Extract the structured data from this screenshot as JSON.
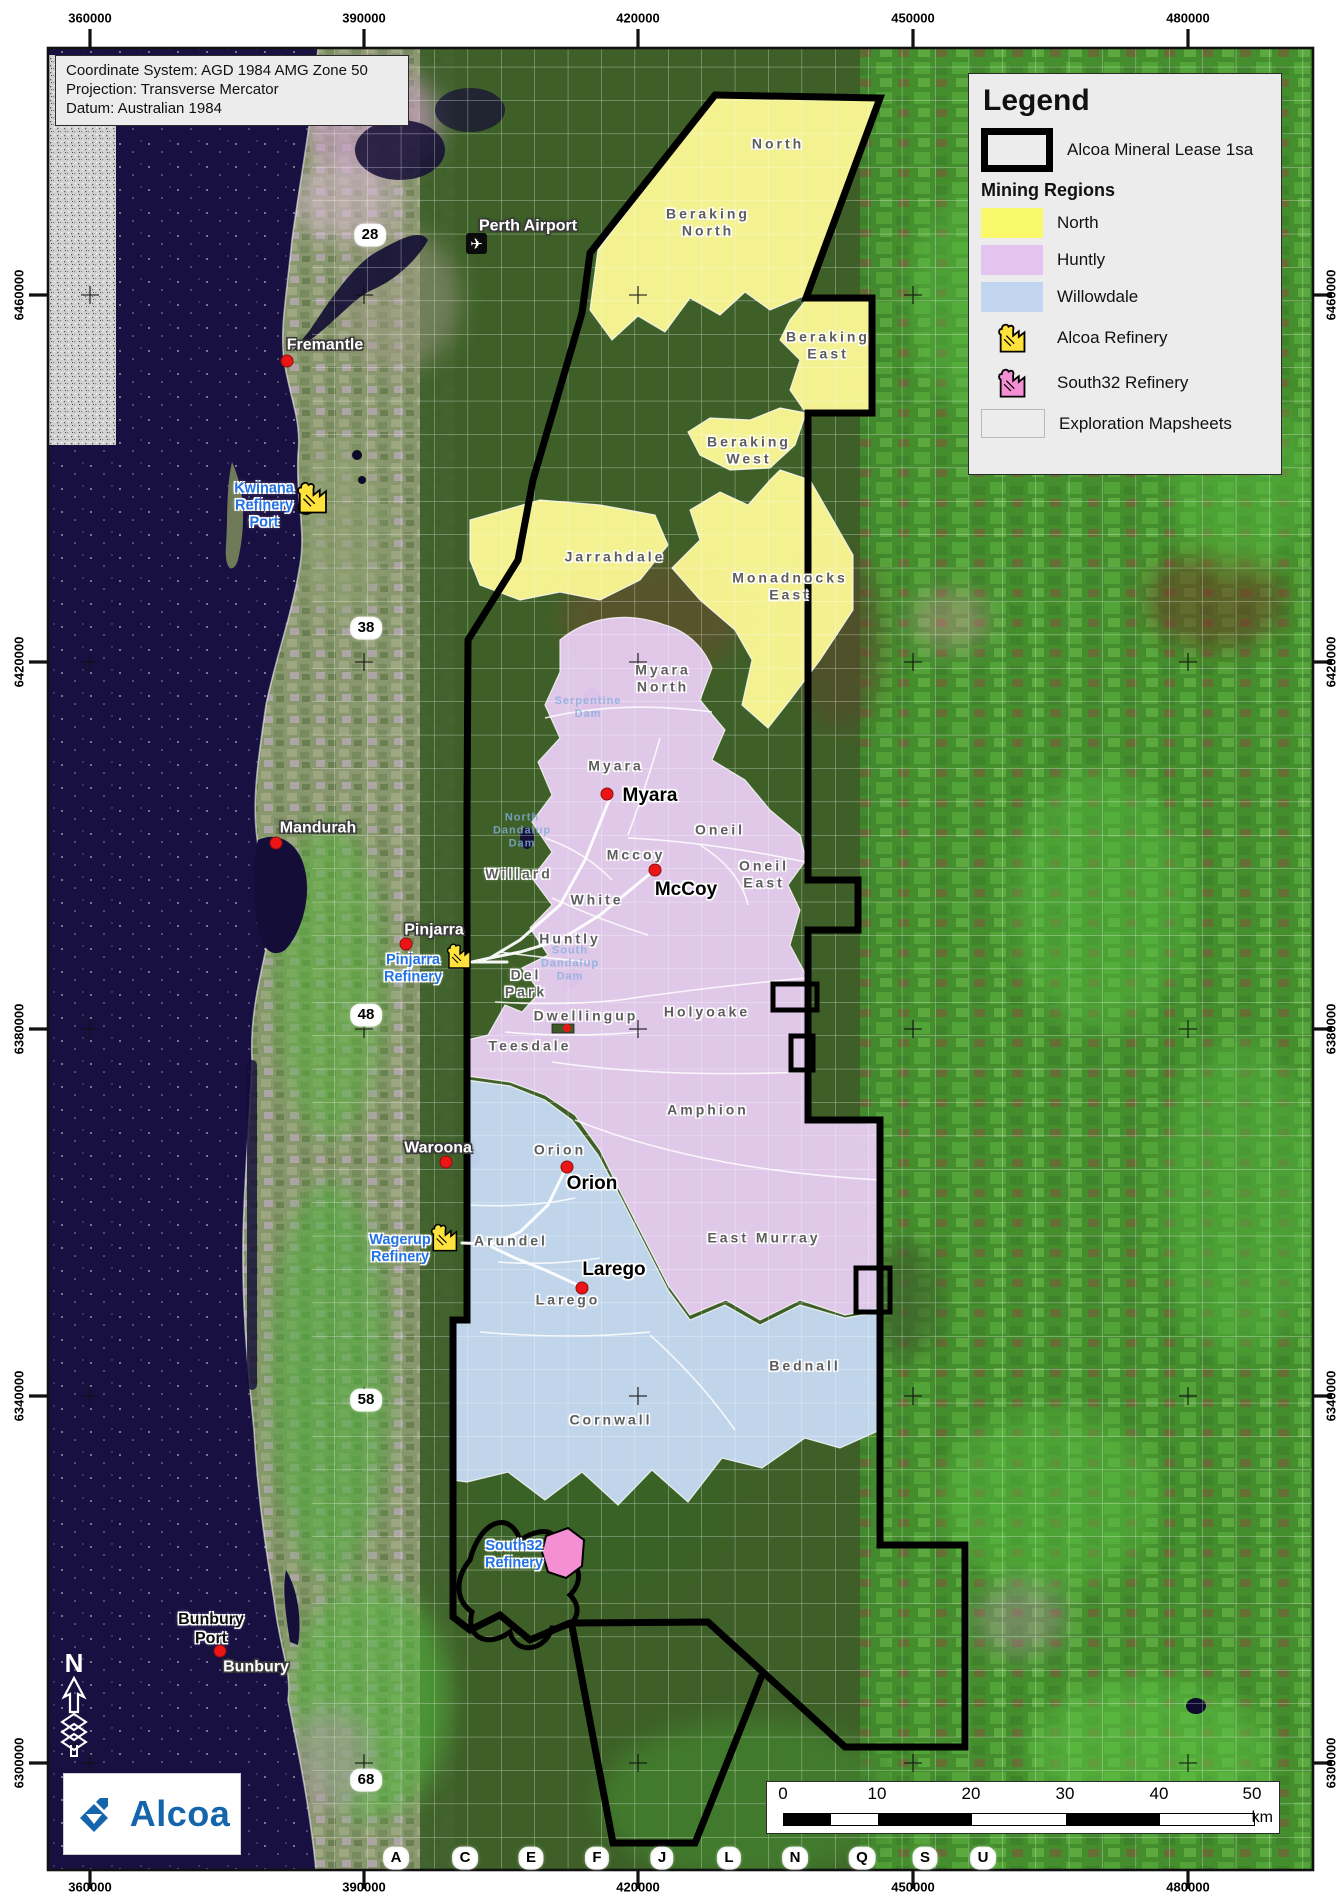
{
  "info_box": {
    "lines": [
      "Coordinate System: AGD 1984 AMG Zone 50",
      "Projection: Transverse Mercator",
      "Datum: Australian 1984"
    ]
  },
  "legend": {
    "title": "Legend",
    "lease_label": "Alcoa Mineral Lease 1sa",
    "mining_heading": "Mining Regions",
    "items": [
      {
        "label": "North",
        "color": "#FAF96B",
        "type": "region-swatch"
      },
      {
        "label": "Huntly",
        "color": "#E4C3F0",
        "type": "region-swatch"
      },
      {
        "label": "Willowdale",
        "color": "#C2D6F2",
        "type": "region-swatch"
      },
      {
        "label": "Alcoa Refinery",
        "color": "#FFE23B",
        "type": "refinery-icon"
      },
      {
        "label": "South32 Refinery",
        "color": "#F48FD4",
        "type": "refinery-icon"
      },
      {
        "label": "Exploration Mapsheets",
        "color": "#ECECEC",
        "type": "mapsheet-grid"
      }
    ]
  },
  "axes": {
    "top": [
      {
        "t": "360000",
        "x": 90
      },
      {
        "t": "390000",
        "x": 364
      },
      {
        "t": "420000",
        "x": 638
      },
      {
        "t": "450000",
        "x": 913
      },
      {
        "t": "480000",
        "x": 1188
      }
    ],
    "bottom": [
      {
        "t": "360000",
        "x": 90
      },
      {
        "t": "390000",
        "x": 364
      },
      {
        "t": "420000",
        "x": 638
      },
      {
        "t": "450000",
        "x": 913
      },
      {
        "t": "480000",
        "x": 1188
      }
    ],
    "left": [
      {
        "t": "6460000",
        "y": 295
      },
      {
        "t": "6420000",
        "y": 662
      },
      {
        "t": "6380000",
        "y": 1029
      },
      {
        "t": "6340000",
        "y": 1396
      },
      {
        "t": "6300000",
        "y": 1763
      }
    ],
    "right": [
      {
        "t": "6460000",
        "y": 295
      },
      {
        "t": "6420000",
        "y": 662
      },
      {
        "t": "6380000",
        "y": 1029
      },
      {
        "t": "6340000",
        "y": 1396
      },
      {
        "t": "6300000",
        "y": 1763
      }
    ]
  },
  "mapsheet_rows": [
    {
      "t": "28",
      "x": 370,
      "y": 235
    },
    {
      "t": "38",
      "x": 366,
      "y": 628
    },
    {
      "t": "48",
      "x": 366,
      "y": 1015
    },
    {
      "t": "58",
      "x": 366,
      "y": 1400
    },
    {
      "t": "68",
      "x": 366,
      "y": 1780
    }
  ],
  "mapsheet_cols": [
    {
      "t": "A",
      "x": 396,
      "y": 1858
    },
    {
      "t": "C",
      "x": 465,
      "y": 1858
    },
    {
      "t": "E",
      "x": 531,
      "y": 1858
    },
    {
      "t": "F",
      "x": 597,
      "y": 1858
    },
    {
      "t": "J",
      "x": 662,
      "y": 1858
    },
    {
      "t": "L",
      "x": 729,
      "y": 1858
    },
    {
      "t": "N",
      "x": 795,
      "y": 1858
    },
    {
      "t": "Q",
      "x": 862,
      "y": 1858
    },
    {
      "t": "S",
      "x": 925,
      "y": 1858
    },
    {
      "t": "U",
      "x": 983,
      "y": 1858
    }
  ],
  "regions": [
    {
      "t": "North",
      "x": 778,
      "y": 144
    },
    {
      "t": "Beraking\nNorth",
      "x": 708,
      "y": 222
    },
    {
      "t": "Beraking\nEast",
      "x": 828,
      "y": 345
    },
    {
      "t": "Beraking\nWest",
      "x": 749,
      "y": 450
    },
    {
      "t": "Jarrahdale",
      "x": 615,
      "y": 557
    },
    {
      "t": "Monadnocks\nEast",
      "x": 790,
      "y": 586
    },
    {
      "t": "Myara\nNorth",
      "x": 663,
      "y": 678
    },
    {
      "t": "Myara",
      "x": 616,
      "y": 766
    },
    {
      "t": "Oneil",
      "x": 720,
      "y": 830
    },
    {
      "t": "Mccoy",
      "x": 636,
      "y": 855
    },
    {
      "t": "Oneil\nEast",
      "x": 764,
      "y": 874
    },
    {
      "t": "Willard",
      "x": 519,
      "y": 874
    },
    {
      "t": "White",
      "x": 597,
      "y": 900
    },
    {
      "t": "Huntly",
      "x": 570,
      "y": 939
    },
    {
      "t": "Del\nPark",
      "x": 526,
      "y": 983
    },
    {
      "t": "Dwellingup",
      "x": 586,
      "y": 1016
    },
    {
      "t": "Teesdale",
      "x": 530,
      "y": 1046
    },
    {
      "t": "Holyoake",
      "x": 707,
      "y": 1012
    },
    {
      "t": "Amphion",
      "x": 708,
      "y": 1110
    },
    {
      "t": "Orion",
      "x": 560,
      "y": 1150
    },
    {
      "t": "Arundel",
      "x": 511,
      "y": 1241
    },
    {
      "t": "East Murray",
      "x": 764,
      "y": 1238
    },
    {
      "t": "Larego",
      "x": 568,
      "y": 1300
    },
    {
      "t": "Bednall",
      "x": 805,
      "y": 1366
    },
    {
      "t": "Cornwall",
      "x": 611,
      "y": 1420
    }
  ],
  "mines": [
    {
      "t": "Myara",
      "x": 650,
      "y": 796,
      "dx": 607,
      "dy": 794
    },
    {
      "t": "McCoy",
      "x": 686,
      "y": 890,
      "dx": 655,
      "dy": 870
    },
    {
      "t": "Orion",
      "x": 592,
      "y": 1184,
      "dx": 567,
      "dy": 1167
    },
    {
      "t": "Larego",
      "x": 614,
      "y": 1270,
      "dx": 582,
      "dy": 1288
    }
  ],
  "towns": [
    {
      "t": "Fremantle",
      "x": 325,
      "y": 346,
      "dx": 287,
      "dy": 361
    },
    {
      "t": "Perth Airport",
      "x": 528,
      "y": 227
    },
    {
      "t": "Mandurah",
      "x": 318,
      "y": 829,
      "dx": 276,
      "dy": 843
    },
    {
      "t": "Pinjarra",
      "x": 434,
      "y": 931,
      "dx": 406,
      "dy": 944
    },
    {
      "t": "Waroona",
      "x": 438,
      "y": 1149,
      "dx": 446,
      "dy": 1162
    },
    {
      "t": "Bunbury",
      "x": 256,
      "y": 1668
    }
  ],
  "ports": [
    {
      "t": "Bunbury\nPort",
      "x": 211,
      "y": 1630,
      "dx": 220,
      "dy": 1651
    }
  ],
  "refinery_labels": [
    {
      "t": "Kwinana\nRefinery\nPort",
      "x": 264,
      "y": 506
    },
    {
      "t": "Pinjarra\nRefinery",
      "x": 413,
      "y": 969
    },
    {
      "t": "Wagerup\nRefinery",
      "x": 400,
      "y": 1249
    },
    {
      "t": "South32\nRefinery",
      "x": 514,
      "y": 1555
    }
  ],
  "dams": [
    {
      "t": "Serpentine\nDam",
      "x": 588,
      "y": 708
    },
    {
      "t": "North\nDandalup\nDam",
      "x": 522,
      "y": 831
    },
    {
      "t": "South\nDandalup\nDam",
      "x": 570,
      "y": 964
    }
  ],
  "scalebar": {
    "ticks": [
      "0",
      "10",
      "20",
      "30",
      "40",
      "50"
    ],
    "tick_x": [
      16,
      110,
      204,
      298,
      392,
      485
    ],
    "segments": [
      47,
      47,
      94,
      94,
      94,
      94
    ],
    "unit": "km"
  },
  "logo": {
    "text": "Alcoa"
  },
  "north_arrow": {
    "letter": "N"
  },
  "colors": {
    "north_region": "#FBF795",
    "huntly_region": "#E8CDF2",
    "willowdale_region": "#C7DAF4",
    "lease_outline": "#000000",
    "refinery_label_blue": "#2273E8",
    "ocean": "#191042",
    "south32_pink": "#F48FD4",
    "alcoa_refinery_yellow": "#FFE23B",
    "alcoa_blue": "#1565AD"
  }
}
